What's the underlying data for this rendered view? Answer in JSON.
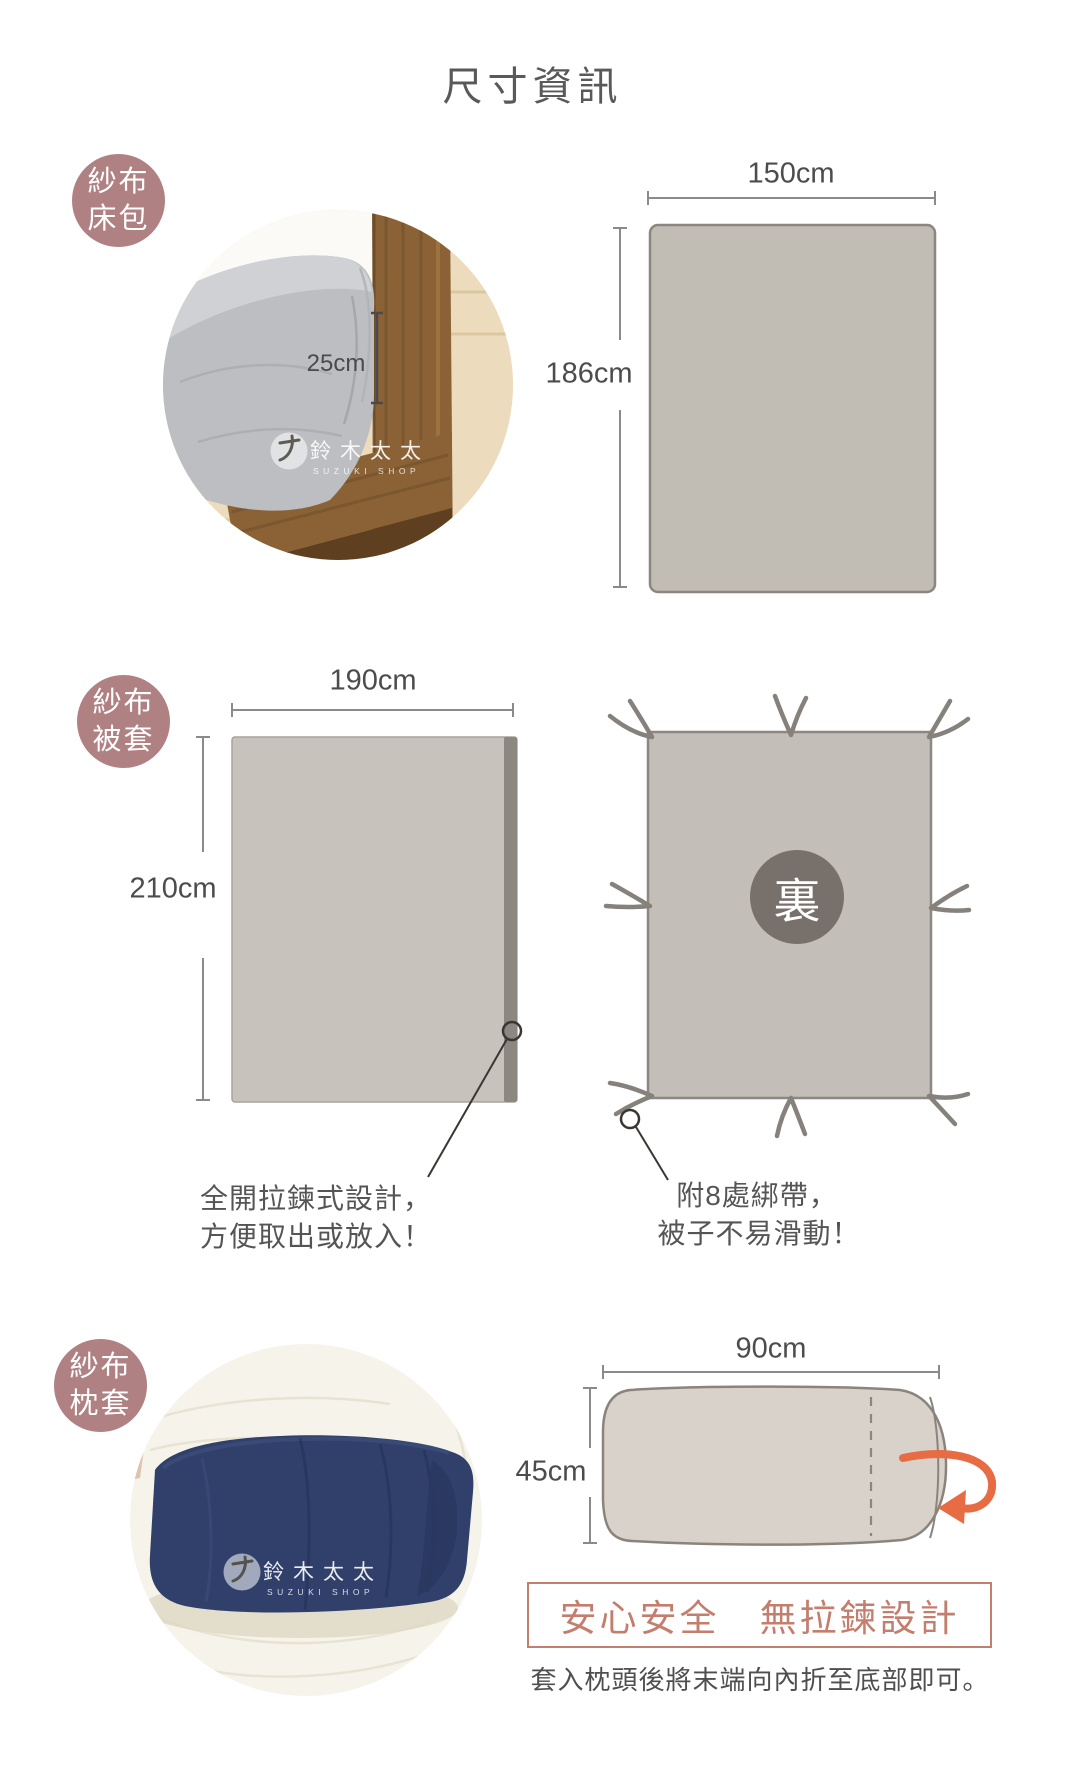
{
  "title": "尺寸資訊",
  "colors": {
    "badge_rose": "#b08183",
    "diagram_fill": "#c1bcb4",
    "diagram_stroke": "#8b8680",
    "zipper_strip": "#8d8781",
    "back_circle": "#78706b",
    "accent_terracotta": "#c47e6e",
    "arrow_orange": "#e76b43",
    "text_gray": "#595959"
  },
  "sheet_section": {
    "badge": {
      "line1": "紗布",
      "line2": "床包"
    },
    "photo_depth_label": "25cm",
    "width_label": "150cm",
    "height_label": "186cm",
    "watermark": {
      "brand": "鈴木太太",
      "sub": "SUZUKI SHOP"
    }
  },
  "duvet_section": {
    "badge": {
      "line1": "紗布",
      "line2": "被套"
    },
    "width_label": "190cm",
    "height_label": "210cm",
    "back_badge": "裏",
    "zipper_note": {
      "line1": "全開拉鍊式設計，",
      "line2": "方便取出或放入！"
    },
    "ties_note": {
      "line1": "附8處綁帶，",
      "line2": "被子不易滑動！"
    }
  },
  "pillow_section": {
    "badge": {
      "line1": "紗布",
      "line2": "枕套"
    },
    "width_label": "90cm",
    "height_label": "45cm",
    "safety_banner": "安心安全　無拉鍊設計",
    "instruction": "套入枕頭後將末端向內折至底部即可。",
    "watermark": {
      "brand": "鈴木太太",
      "sub": "SUZUKI SHOP"
    }
  }
}
